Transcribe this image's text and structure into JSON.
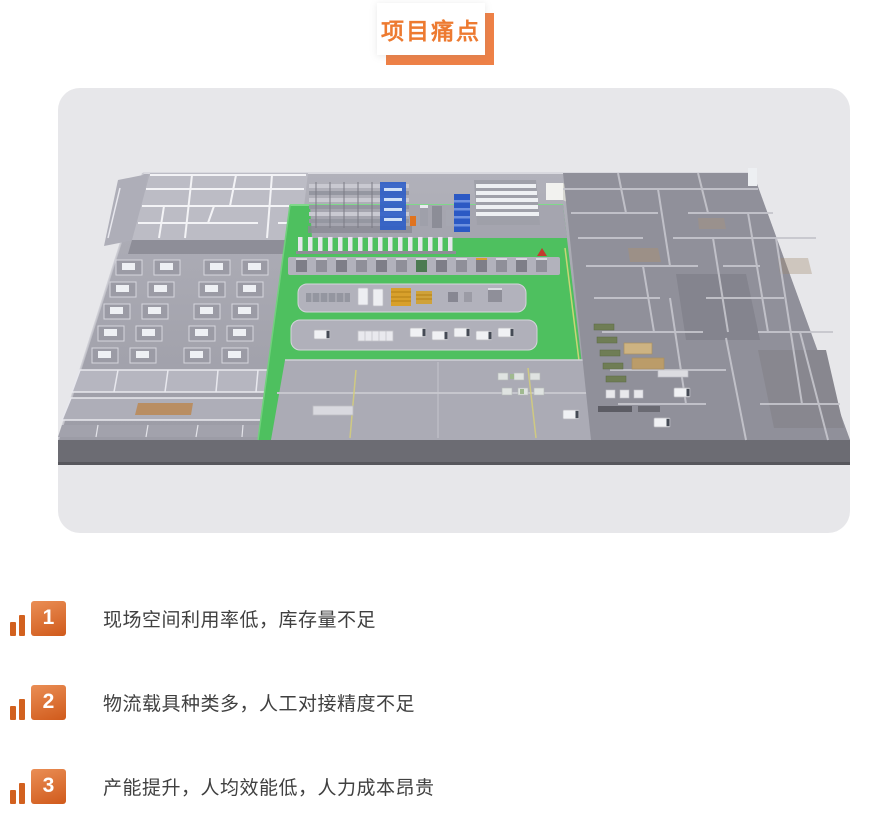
{
  "header": {
    "title": "项目痛点"
  },
  "theme": {
    "accent_orange": "#ED7A30",
    "badge_shadow_orange": "#EE8147",
    "number_gradient_top": "#EA8E55",
    "number_gradient_bottom": "#D05A1B",
    "body_text_color": "#404040",
    "card_background": "#E7E7EA",
    "floor_green": "#4EC05F",
    "rack_blue": "#2E5EC8"
  },
  "factory_scene": {
    "description": "3D isometric factory floor-plan render: office block and machine rows on the left, green logistics floor with storage racks, conveyor line, AGV and truck areas in the center, partitioned warehouse rooms on the right"
  },
  "pain_points": [
    {
      "number": "1",
      "text": "现场空间利用率低，库存量不足"
    },
    {
      "number": "2",
      "text": "物流载具种类多，人工对接精度不足"
    },
    {
      "number": "3",
      "text": "产能提升，人均效能低，人力成本昂贵"
    }
  ]
}
